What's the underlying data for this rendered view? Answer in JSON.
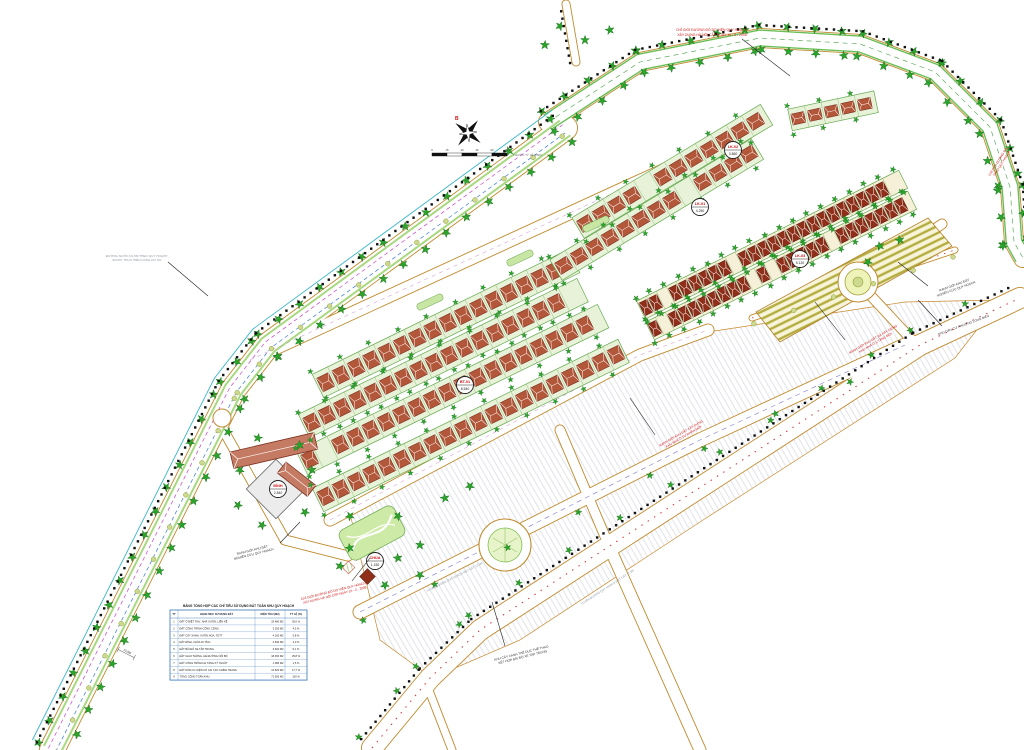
{
  "title": "Bản đồ quy hoạch chi tiết khu nhà ở",
  "colors": {
    "road_edge": "#c08a2e",
    "tree_green": "#2ca32c",
    "house_red": "#b3573a",
    "dense_house_red": "#8f2f1a",
    "boundary_black": "#111111",
    "annotation_red": "#cc1111",
    "water_cyan": "#3ab5c9",
    "legend_grid_blue": "#4f86c0",
    "lot_green": "#e7f2d9",
    "parking_olive": "#b4ad3e"
  },
  "compass": {
    "north_label": "B"
  },
  "scalebar": {
    "labels": [
      "0",
      "15",
      "30",
      "45",
      "60",
      "75m"
    ],
    "caption": "THƯỚC TỶ LỆ 1/500"
  },
  "annotations": {
    "top_red": {
      "l1": "CHỈ GIỚI ĐƯỜNG ĐỎ DO VIỆN QUY HOẠCH",
      "l2": "XÂY DỰNG HÀ NỘI CẤP NGÀY 10 - 2 - 2008"
    },
    "topright_red": {
      "l1": "CHỈ GIỚI ĐƯỜNG ĐỎ",
      "l2": "THEO QUY HOẠCH"
    },
    "right_boundary": {
      "l1": "RANH GIỚI KHU ĐẤT",
      "l2": "NGHIÊN CỨU QUY HOẠCH"
    },
    "right_area": {
      "l1": "KHU DÂN CƯ PHƯỜNG LONG BIÊN"
    },
    "mid_red": {
      "l1": "RANH GIỚI KHU ĐẤT ĐÃ XÂY DỰNG",
      "l2": "KHU NHÀ Ở 5 TẦNG MỚI"
    },
    "center_red": {
      "l1": "RANH GIỚI KHU ĐẤT XÂY DỰNG",
      "l2": "KHU NHÀ Ở TƯ NHÂN MỚI"
    },
    "bl_boundary": {
      "l1": "RANH GIỚI KHU ĐẤT",
      "l2": "NGHIÊN CỨU QUY HOẠCH"
    },
    "bl_red": {
      "l1": "CHỈ GIỚI ĐƯỜNG ĐỎ DO VIỆN QUY HOẠCH",
      "l2": "XÂY DỰNG HÀ NỘI CẤP NGÀY 10 - 2 - 2008"
    },
    "left_water": {
      "l1": "ĐƯỜNG NƯỚC D1,5M THEO QUY HOẠCH",
      "l2": "ĐƯỢC THỰC HIỆN CÙNG DỰ ÁN"
    },
    "bottom_park": {
      "l1": "KHU CÂY XANH THỂ DỤC THỂ THAO",
      "l2": "KẾT HỢP BÃI ĐỖ XE TẬP TRUNG"
    },
    "road_label_1": "TUYẾN ĐƯỜNG QUY HOẠCH MẶT CẮT 13,5M",
    "road_label_2": "TUYẾN ĐƯỜNG QUY HOẠCH MẶT CẮT 17,5M",
    "dim_label": "13,5M"
  },
  "stamps": [
    {
      "code": "LK-01",
      "area": "4.250"
    },
    {
      "code": "LK-02",
      "area": "3.860"
    },
    {
      "code": "LK-03",
      "area": "5.120"
    },
    {
      "code": "BT-01",
      "area": "8.640"
    },
    {
      "code": "ĐÌNH",
      "area": "2.840"
    },
    {
      "code": "CHÙA",
      "area": "1.150"
    }
  ],
  "legend": {
    "title": "BẢNG TỔNG HỢP CÁC CHỈ TIÊU SỬ DỤNG ĐẤT TOÀN KHU QUY HOẠCH",
    "headers": [
      "TT",
      "HẠNG MỤC SỬ DỤNG ĐẤT",
      "DIỆN TÍCH (M2)",
      "TỶ LỆ (%)"
    ],
    "rows": [
      [
        "1",
        "ĐẤT Ở BIỆT THỰ, NHÀ VƯỜN, LIỀN KỀ",
        "25.480 M2",
        "35,6 %"
      ],
      [
        "2",
        "ĐẤT CÔNG TRÌNH CÔNG CỘNG",
        "3.250 M2",
        "4,5 %"
      ],
      [
        "3",
        "ĐẤT CÂY XANH, VƯỜN HOA, TDTT",
        "4.160 M2",
        "5,8 %"
      ],
      [
        "4",
        "ĐẤT ĐÌNH, CHÙA DI TÍCH",
        "2.840 M2",
        "4,0 %"
      ],
      [
        "5",
        "ĐẤT BÃI ĐỖ XE TẬP TRUNG",
        "3.620 M2",
        "5,1 %"
      ],
      [
        "6",
        "ĐẤT GIAO THÔNG, HÈ ĐƯỜNG NỘI BỘ",
        "18.450 M2",
        "25,8 %"
      ],
      [
        "7",
        "ĐẤT CÔNG TRÌNH HẠ TẦNG KỸ THUẬT",
        "1.080 M2",
        "1,5 %"
      ],
      [
        "8",
        "ĐẤT DÂN CƯ HIỆN CÓ CẢI TẠO CHỈNH TRANG",
        "12.620 M2",
        "17,7 %"
      ],
      [
        "9",
        "TỔNG CỘNG TOÀN KHU",
        "71.500 M2",
        "100 %"
      ]
    ]
  }
}
